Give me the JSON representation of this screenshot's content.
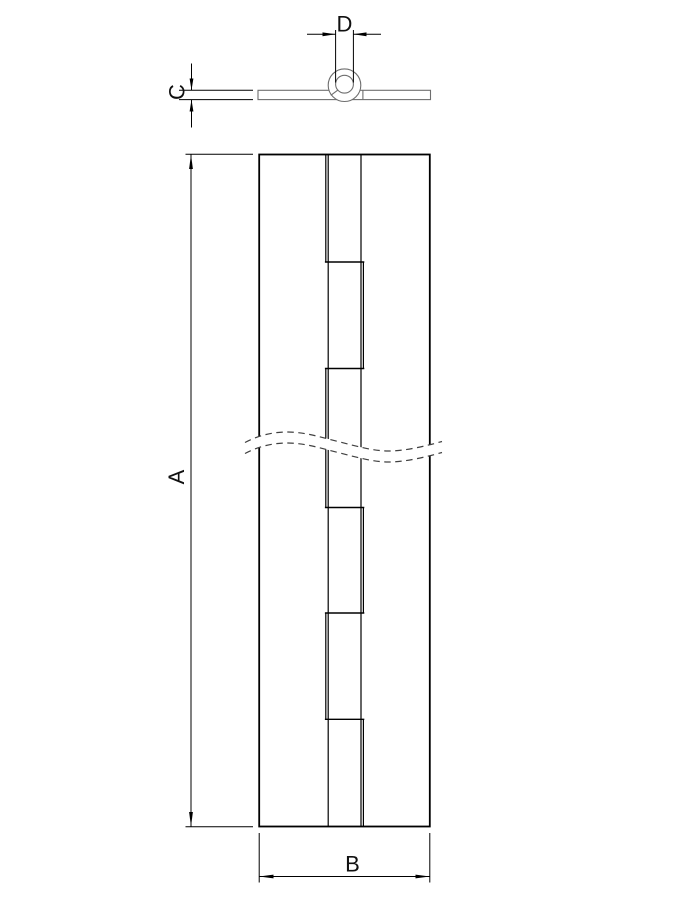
{
  "labels": {
    "length": "A",
    "width": "B",
    "thickness": "C",
    "knuckle_diameter": "D"
  },
  "colors": {
    "dimension_line": "#000000",
    "shape_secondary": "#6e6e6e",
    "label_text": "#101010",
    "background": "#ffffff"
  }
}
